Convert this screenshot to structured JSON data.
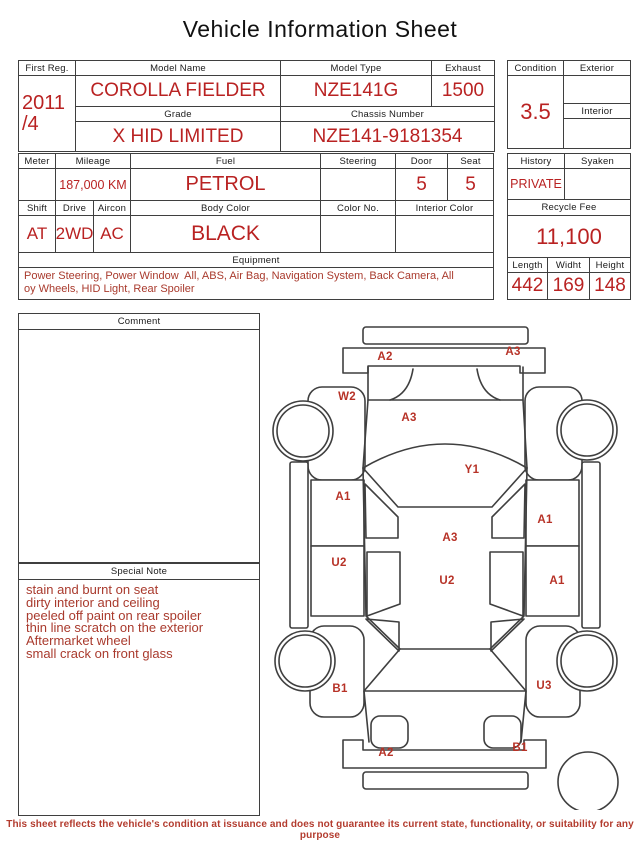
{
  "title": "Vehicle Information Sheet",
  "footer": "This sheet reflects the vehicle's condition at issuance and does not guarantee its current state, functionality, or suitability for any purpose",
  "info": {
    "first_reg_label": "First Reg.",
    "first_reg_value": "2011\n/4",
    "model_name_label": "Model Name",
    "model_name_value": "COROLLA FIELDER",
    "model_type_label": "Model Type",
    "model_type_value": "NZE141G",
    "exhaust_label": "Exhaust",
    "exhaust_value": "1500",
    "grade_label": "Grade",
    "grade_value": "X HID LIMITED",
    "chassis_label": "Chassis Number",
    "chassis_value": "NZE141-9181354",
    "condition_label": "Condition",
    "condition_value": "3.5",
    "exterior_label": "Exterior",
    "exterior_value": "",
    "interior_label": "Interior",
    "interior_value": ""
  },
  "spec": {
    "meter_label": "Meter",
    "meter_value": "",
    "mileage_label": "Mileage",
    "mileage_value": "187,000 KM",
    "fuel_label": "Fuel",
    "fuel_value": "PETROL",
    "steering_label": "Steering",
    "steering_value": "",
    "door_label": "Door",
    "door_value": "5",
    "seat_label": "Seat",
    "seat_value": "5",
    "shift_label": "Shift",
    "shift_value": "AT",
    "drive_label": "Drive",
    "drive_value": "2WD",
    "aircon_label": "Aircon",
    "aircon_value": "AC",
    "body_color_label": "Body Color",
    "body_color_value": "BLACK",
    "color_no_label": "Color No.",
    "color_no_value": "",
    "interior_color_label": "Interior Color",
    "interior_color_value": "",
    "equipment_label": "Equipment",
    "equipment_value": "Power Steering, Power Window  All, ABS, Air Bag, Navigation System, Back Camera, All\noy Wheels, HID Light, Rear Spoiler"
  },
  "right_panel": {
    "history_label": "History",
    "history_value": "PRIVATE",
    "syaken_label": "Syaken",
    "syaken_value": "",
    "recycle_fee_label": "Recycle Fee",
    "recycle_fee_value": "11,100",
    "length_label": "Length",
    "length_value": "442",
    "width_label": "Widht",
    "width_value": "169",
    "height_label": "Height",
    "height_value": "148"
  },
  "comment": {
    "label": "Comment",
    "value": ""
  },
  "special_note": {
    "label": "Special Note",
    "lines": [
      "stain and burnt on seat",
      "dirty interior and ceiling",
      "peeled off paint on rear spoiler",
      "thin line scratch on the exterior",
      "Aftermarket wheel",
      "small crack on front glass"
    ]
  },
  "diagram": {
    "damage_marks": [
      {
        "code": "A2",
        "x": 385,
        "y": 357
      },
      {
        "code": "A3",
        "x": 513,
        "y": 352
      },
      {
        "code": "W2",
        "x": 347,
        "y": 397
      },
      {
        "code": "A3",
        "x": 409,
        "y": 418
      },
      {
        "code": "Y1",
        "x": 472,
        "y": 470
      },
      {
        "code": "A1",
        "x": 343,
        "y": 497
      },
      {
        "code": "A1",
        "x": 545,
        "y": 520
      },
      {
        "code": "A3",
        "x": 450,
        "y": 538
      },
      {
        "code": "U2",
        "x": 339,
        "y": 563
      },
      {
        "code": "U2",
        "x": 447,
        "y": 581
      },
      {
        "code": "A1",
        "x": 557,
        "y": 581
      },
      {
        "code": "B1",
        "x": 340,
        "y": 689
      },
      {
        "code": "U3",
        "x": 544,
        "y": 686
      },
      {
        "code": "A2",
        "x": 386,
        "y": 753
      },
      {
        "code": "B1",
        "x": 520,
        "y": 748
      }
    ]
  }
}
